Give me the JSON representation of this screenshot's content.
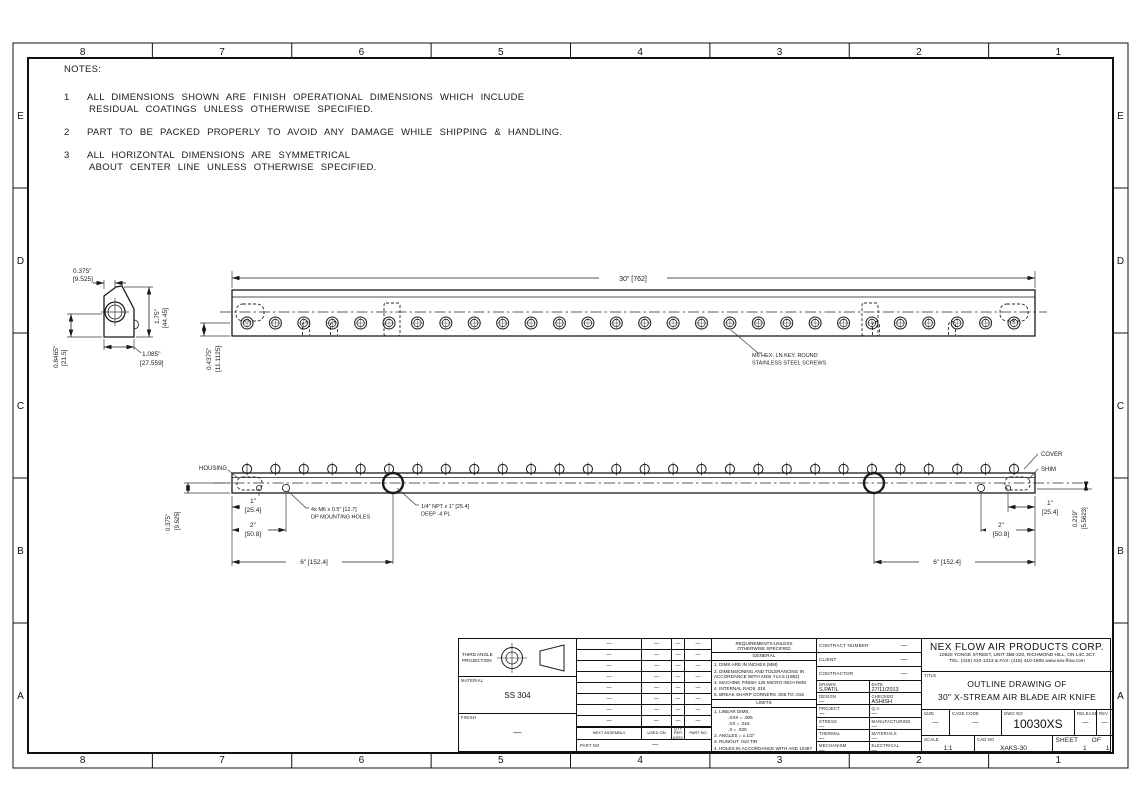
{
  "zones": {
    "columns": [
      "8",
      "7",
      "6",
      "5",
      "4",
      "3",
      "2",
      "1"
    ],
    "rows": [
      "E",
      "D",
      "C",
      "B",
      "A"
    ]
  },
  "notes": {
    "heading": "NOTES:",
    "items": [
      {
        "num": "1",
        "lines": [
          "ALL DIMENSIONS SHOWN ARE FINISH OPERATIONAL DIMENSIONS WHICH INCLUDE",
          "RESIDUAL COATINGS UNLESS OTHERWISE SPECIFIED."
        ]
      },
      {
        "num": "2",
        "lines": [
          "PART TO BE PACKED PROPERLY TO AVOID ANY DAMAGE WHILE SHIPPING & HANDLING."
        ]
      },
      {
        "num": "3",
        "lines": [
          "ALL HORIZONTAL DIMENSIONS ARE SYMMETRICAL",
          "ABOUT CENTER LINE UNLESS OTHERWISE SPECIFIED."
        ]
      }
    ]
  },
  "end_view": {
    "dim_top_width": "0.375\"",
    "dim_top_width_mm": "[9.525]",
    "dim_height": "1.75\"",
    "dim_height_mm": "[44.45]",
    "dim_left_height": "0.8465\"",
    "dim_left_height_mm": "[21.5]",
    "dim_bottom_width": "1.085\"",
    "dim_bottom_width_mm": "[27.559]"
  },
  "top_view": {
    "dim_overall": "30\" [762]",
    "dim_center_offset": "0.4375\"",
    "dim_center_offset_mm": "[11.1125]",
    "screw_note_line1": "M6 HEX. LN KEY. ROUND",
    "screw_note_line2": "STAINLESS STEEL SCREWS"
  },
  "bottom_view": {
    "label_housing": "HOUSING",
    "label_cover": "COVER",
    "label_shim": "SHIM",
    "dim_slot_height": "0.375\"",
    "dim_slot_height_mm": "[9.525]",
    "dim_gap": "0.219\"",
    "dim_gap_mm": "[5.5623]",
    "dim_1in": "1\"",
    "dim_1in_mm": "[25.4]",
    "dim_2in": "2\"",
    "dim_2in_mm": "[50.8]",
    "dim_6in": "6\" [152.4]",
    "note_mounting_line1": "4x M6 x 0.5\" [12.7]",
    "note_mounting_line2": "DP MOUNTING HOLES",
    "note_npt_line1": "1/4\" NPT x 1\" [25.4]",
    "note_npt_line2": "DEEP -4 PL"
  },
  "title_block": {
    "projection": {
      "line1": "THIRD ANGLE",
      "line2": "PROJECTION"
    },
    "material_label": "MATERIAL",
    "material_value": "SS 304",
    "finish_label": "FINISH",
    "finish_value": "—",
    "parts_table": {
      "headers": [
        "NEXT ASSEMBLY",
        "USED ON",
        "QTY PER ASSY",
        "PART NO"
      ],
      "rows": [
        [
          "—",
          "—",
          "—",
          "—"
        ],
        [
          "—",
          "—",
          "—",
          "—"
        ],
        [
          "—",
          "—",
          "—",
          "—"
        ],
        [
          "—",
          "—",
          "—",
          "—"
        ],
        [
          "—",
          "—",
          "—",
          "—"
        ],
        [
          "—",
          "—",
          "—",
          "—"
        ],
        [
          "—",
          "—",
          "—",
          "—"
        ],
        [
          "—",
          "—",
          "—",
          "—"
        ]
      ],
      "footer_label": "PART NO",
      "footer_value": "—"
    },
    "requirements": {
      "header_line1": "REQUIREMENTS-UNLESS",
      "header_line2": "OTHERWISE SPECIFIED",
      "general_title": "GENERAL",
      "general_items": [
        "1. DIMS ARE IN INCHES (MM)",
        "2. DIMENSIONING AND TOLERANCING IN ACCORDANCE WITH ANSI Y14.5 (1982)",
        "3. MACHINE FINISH 125 MICRO INCH RMS",
        "4. INTERNAL RADII .015",
        "5. BREAK SHARP CORNERS .005 TO .015"
      ],
      "limits_title": "LIMITS",
      "limits_items": [
        {
          "t": "1. LINEAR DIMS.",
          "i": 0
        },
        {
          "t": ".XXX = .005",
          "i": 1
        },
        {
          "t": ".XX = .015",
          "i": 1
        },
        {
          "t": ".X = .030",
          "i": 1
        },
        {
          "t": "2. ANGLES = ± 1/2°",
          "i": 0
        },
        {
          "t": "3. RUNOUT .010 TIR",
          "i": 0
        },
        {
          "t": "4. HOLES IN ACCORDANCE WITH AND 10387",
          "i": 0
        }
      ]
    },
    "approval": {
      "contract_label": "CONTRACT NUMBER",
      "contract_value": "—",
      "client_label": "CLIENT",
      "client_value": "—",
      "contractor_label": "CONTRACTOR",
      "contractor_value": "—",
      "cells": [
        {
          "label": "DRAWN",
          "value": "S.PATIL"
        },
        {
          "label": "DATE",
          "value": "27/11/2013"
        },
        {
          "label": "DESIGN",
          "value": "—"
        },
        {
          "label": "CHECKED",
          "value": "ASHISH"
        },
        {
          "label": "PROJECT",
          "value": "—"
        },
        {
          "label": "Q.A.",
          "value": "—"
        },
        {
          "label": "STRESS",
          "value": "—"
        },
        {
          "label": "MANUFACTURING",
          "value": "—"
        },
        {
          "label": "THERMAL",
          "value": "—"
        },
        {
          "label": "MATERIALS",
          "value": "—"
        },
        {
          "label": "MECHANISM",
          "value": "—"
        },
        {
          "label": "ELECTRICAL",
          "value": "—"
        }
      ]
    },
    "company": {
      "name": "NEX FLOW AIR PRODUCTS CORP.",
      "address": "10520 YONGE STREET, UNIT 35B-220, RICHMOND HILL, ON L4C 3C7",
      "contact": "TEL: (416) 410-1313 & FAX: (416) 410-1806  www.nex-flow.com",
      "title_label": "TITLE",
      "title_line1": "OUTLINE DRAWING OF",
      "title_line2": "30\" X-STREAM AIR BLADE AIR KNIFE",
      "size_label": "SIZE",
      "size_value": "—",
      "cage_label": "CAGE CODE",
      "cage_value": "—",
      "dwg_label": "DWG NO",
      "dwg_value": "10030XS",
      "release_label": "RELEASE",
      "release_value": "—",
      "rev_label": "REV",
      "rev_value": "—",
      "scale_label": "SCALE",
      "scale_value": "1:1",
      "cad_label": "CAD NO",
      "cad_value": "XAKS-30",
      "sheet_label": "SHEET",
      "sheet_value": "1",
      "of_label": "OF",
      "of_value": "1"
    }
  }
}
